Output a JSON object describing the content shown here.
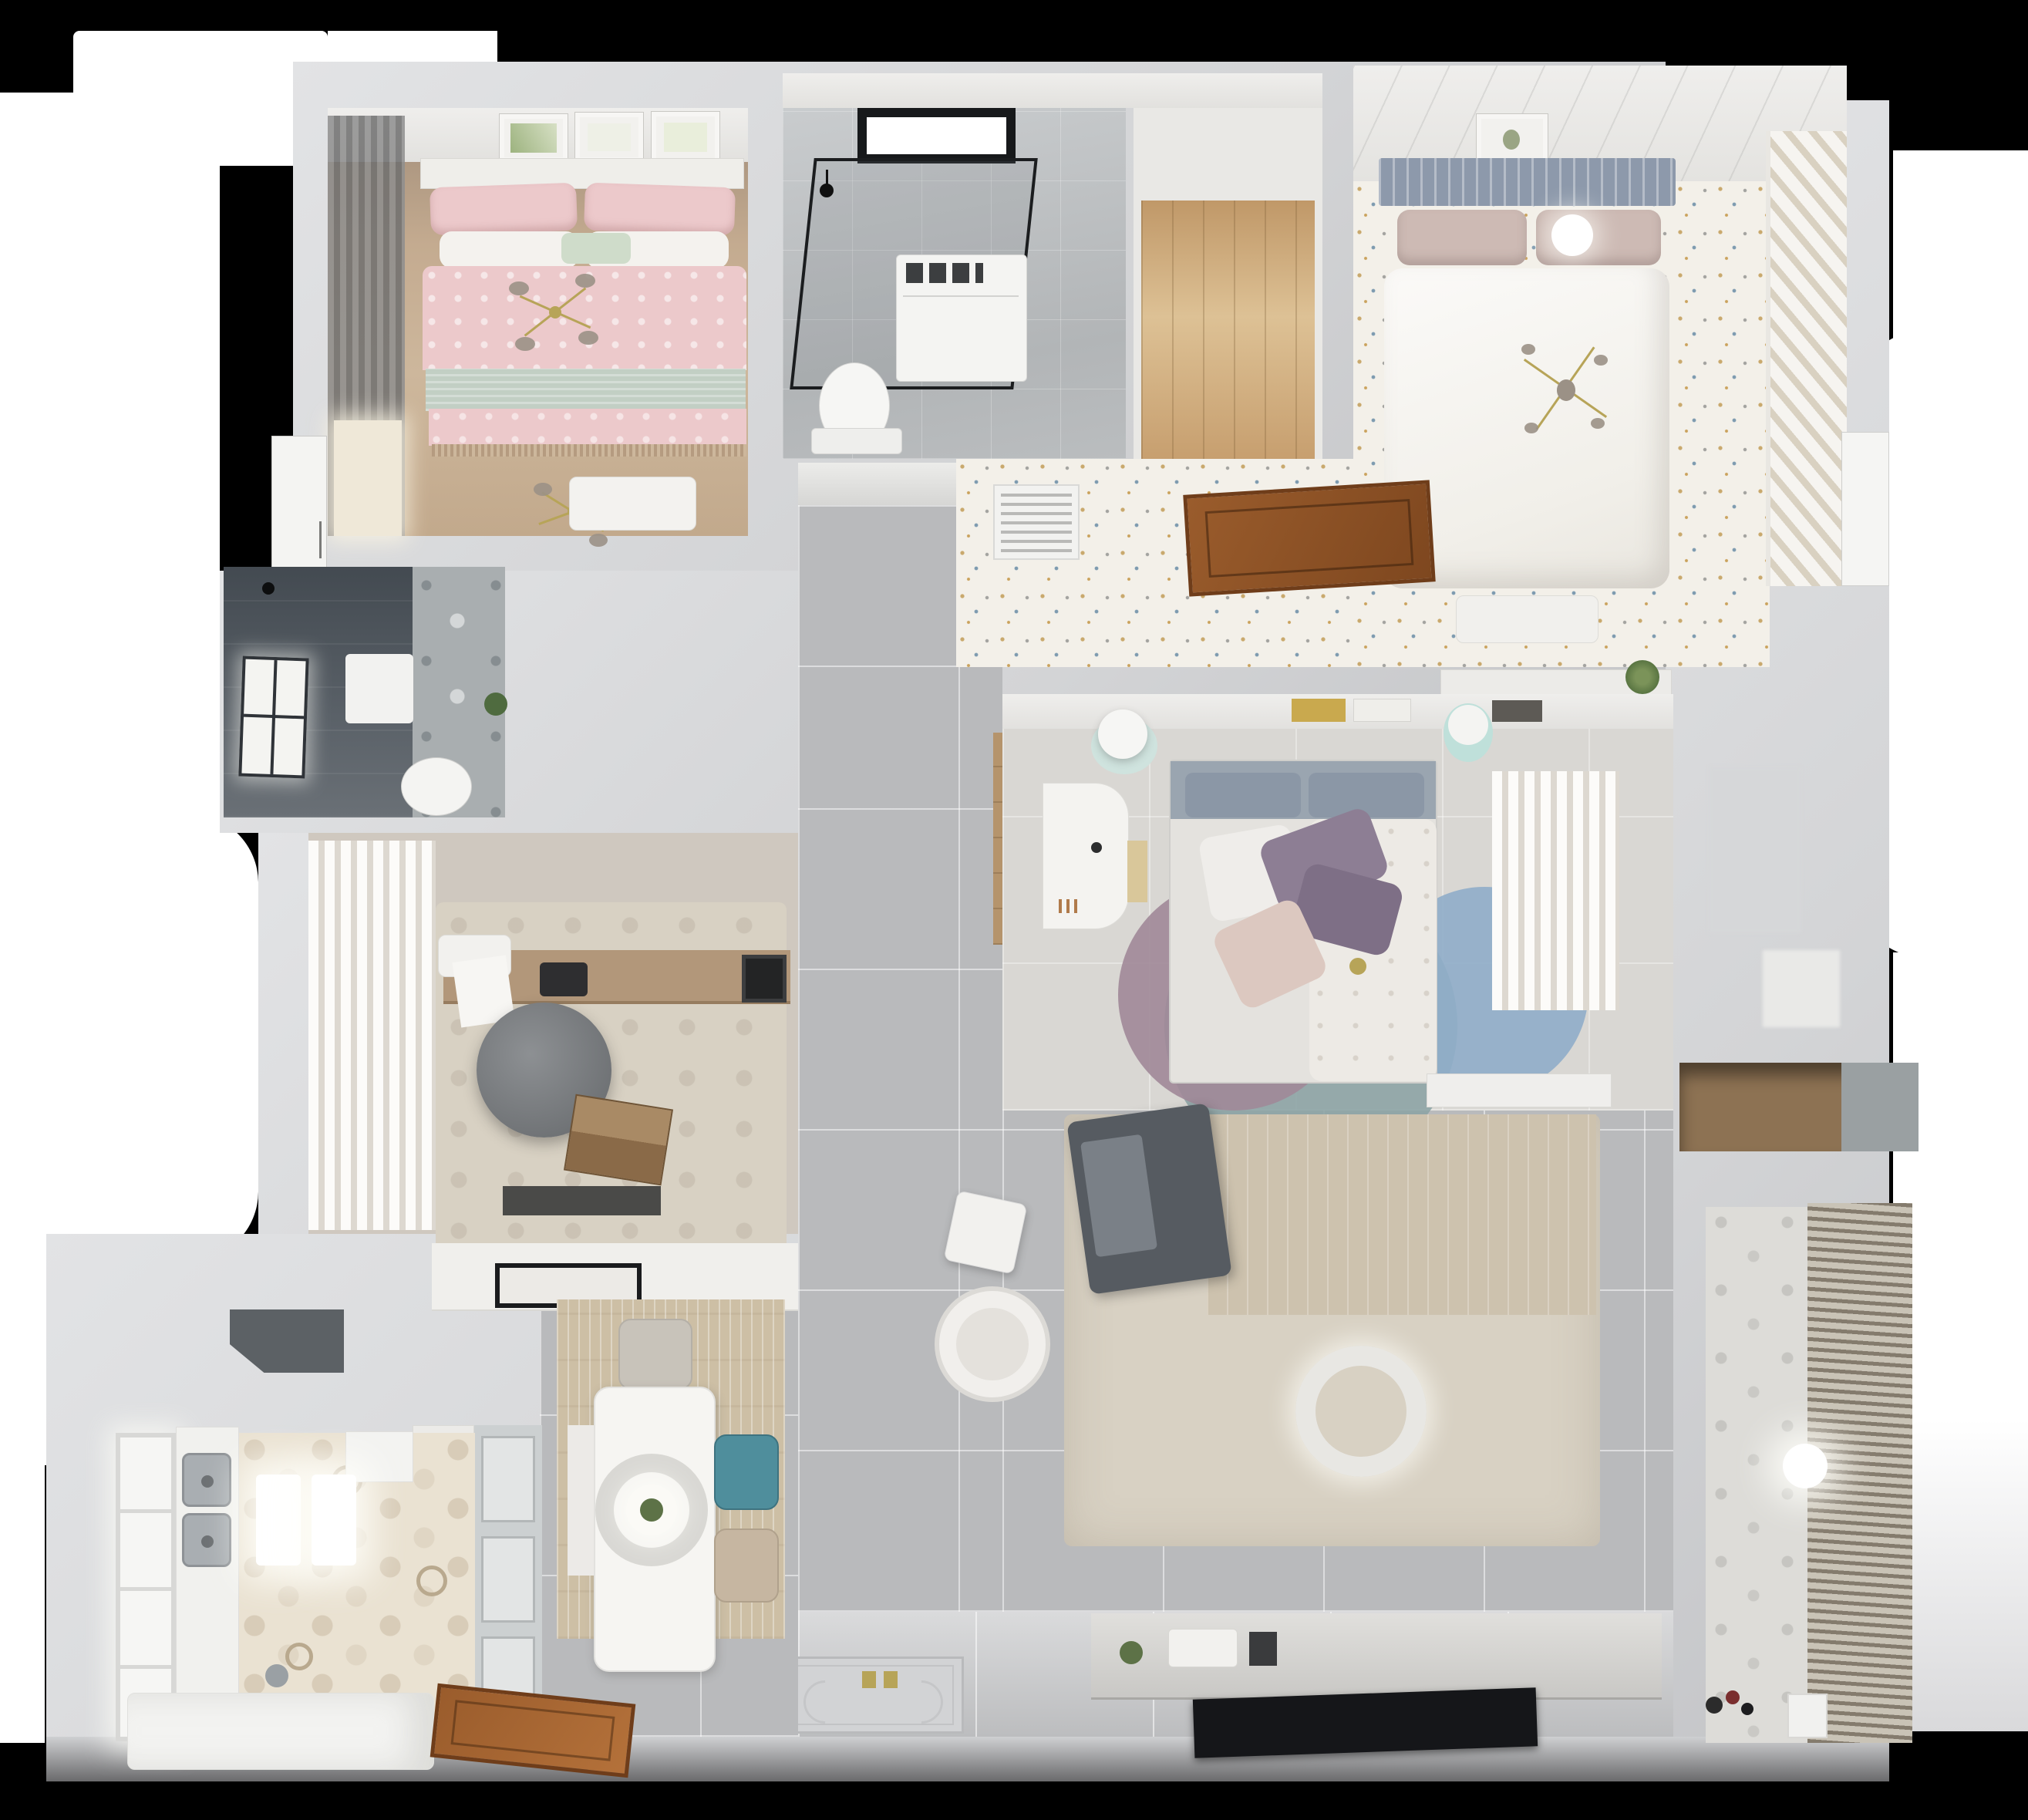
{
  "meta": {
    "title": "Top-down 3D render of an apartment floor plan",
    "view": "bird's-eye interior render",
    "no_visible_text": true
  },
  "colors": {
    "bgWhite": "#ffffff",
    "wall": "#d3d4d6",
    "wallLight": "#e2e3e5",
    "wallShade": "#c2c3c6",
    "tile": "#b9babc",
    "tileLight": "#c6c7c9",
    "terrazzo": "#f3f0e9",
    "hex": "#eae2d2",
    "hexDot": "#d8ccb8",
    "marble": "#a9aeb0",
    "gold": "#b7a458",
    "pinkBed": "#ecc9cb",
    "sageBlanket": "#c2cfc4",
    "bedWoodFloor": "#c4ab90",
    "slateHeadboard": "#8d99ab",
    "blushPillow": "#cdbab4",
    "duvetWhite": "#faf9f6",
    "purplePillow": "#8d7e94",
    "grayHeadboard": "#9aa5b0",
    "rugTeal": "#8ba3a4",
    "rugMauve": "#a08898",
    "rugBlue": "#8fadc9",
    "rugBeige": "#d8d1c3",
    "sofaGray": "#565b61",
    "chairTeal": "#4f8e9c",
    "chairBeige": "#c6b6a1",
    "deskWood": "#b2977a",
    "laptopWood": "#8a6a48",
    "officeChair": "#7e8184",
    "doorBrown": "#9a5c2c",
    "tvBlack": "#151619",
    "plantGreen": "#5d7247",
    "steel": "#a9aeb2"
  },
  "rooms": [
    {
      "id": "bedroom-1",
      "label": "Bedroom 1 – pink bedding, gold chandeliers"
    },
    {
      "id": "bathroom-1",
      "label": "Bathroom 1 – glass shower, skylight, toilet"
    },
    {
      "id": "wardrobe-hall",
      "label": "Wardrobe hallway – wood floor"
    },
    {
      "id": "bedroom-2",
      "label": "Bedroom 2 – white bed, terrazzo floor, closet"
    },
    {
      "id": "dressing-corridor",
      "label": "Dressing corridor – vent grille, wood hatch"
    },
    {
      "id": "bathroom-2",
      "label": "Bathroom 2 – dark slate tiles, window"
    },
    {
      "id": "study",
      "label": "Study – desk, office chair, laptop"
    },
    {
      "id": "bedroom-3",
      "label": "Bedroom 3 – desk, bed, round rugs"
    },
    {
      "id": "hallway",
      "label": "Hallway – large gray tiles"
    },
    {
      "id": "living-room",
      "label": "Living room – sofa, rug, pendant light, TV"
    },
    {
      "id": "dining",
      "label": "Dining – white table, teal chair, pendant"
    },
    {
      "id": "kitchen",
      "label": "Kitchen – hex tile floor, double sink, island"
    },
    {
      "id": "balcony",
      "label": "Balcony – patterned tiles, blinds"
    },
    {
      "id": "niche",
      "label": "Wall niche with wood shelf"
    }
  ],
  "furniture": {
    "bedroom1": [
      "double bed",
      "pink patterned duvet",
      "sage blanket",
      "pillows",
      "two gold bead chandeliers",
      "bench",
      "wall art frames",
      "curtain",
      "white door"
    ],
    "bathroom1": [
      "skylight",
      "glass shower enclosure",
      "shower head",
      "washer cabinet",
      "toilet"
    ],
    "bedroom2": [
      "slatted headboard",
      "blush pillows",
      "white duvet",
      "round ceiling light",
      "sputnik chandelier",
      "striped closet",
      "nightstand",
      "picture frame",
      "vent grille",
      "wood hatch door",
      "plant shelf"
    ],
    "bedroom3": [
      "white desk",
      "mint stools",
      "gray headboard",
      "purple pillows",
      "floral duvet",
      "teal mauve blue round rugs",
      "bookshelf",
      "curtains",
      "bench"
    ],
    "living": [
      "charcoal sofa",
      "beige rug",
      "white armchair",
      "white cube stool",
      "donut pendant lamp",
      "media console",
      "television",
      "entry doormat"
    ],
    "dining": [
      "white dining table",
      "ring pendant with plant",
      "teal chair",
      "beige chair",
      "white chair",
      "bench",
      "cooktop counter",
      "glass partition"
    ],
    "kitchen": [
      "double steel sink",
      "window",
      "range hood",
      "pendant lamps",
      "white island",
      "wood entry door",
      "hex tile floor"
    ],
    "study": [
      "wood desk",
      "round office chair",
      "laptop",
      "white chair",
      "rug",
      "floor mat",
      "curtains"
    ],
    "bathroom2": [
      "window",
      "shower head",
      "towel",
      "toilet",
      "plant"
    ],
    "balcony": [
      "ball lamp",
      "toys",
      "mini chair",
      "roller blinds"
    ]
  }
}
